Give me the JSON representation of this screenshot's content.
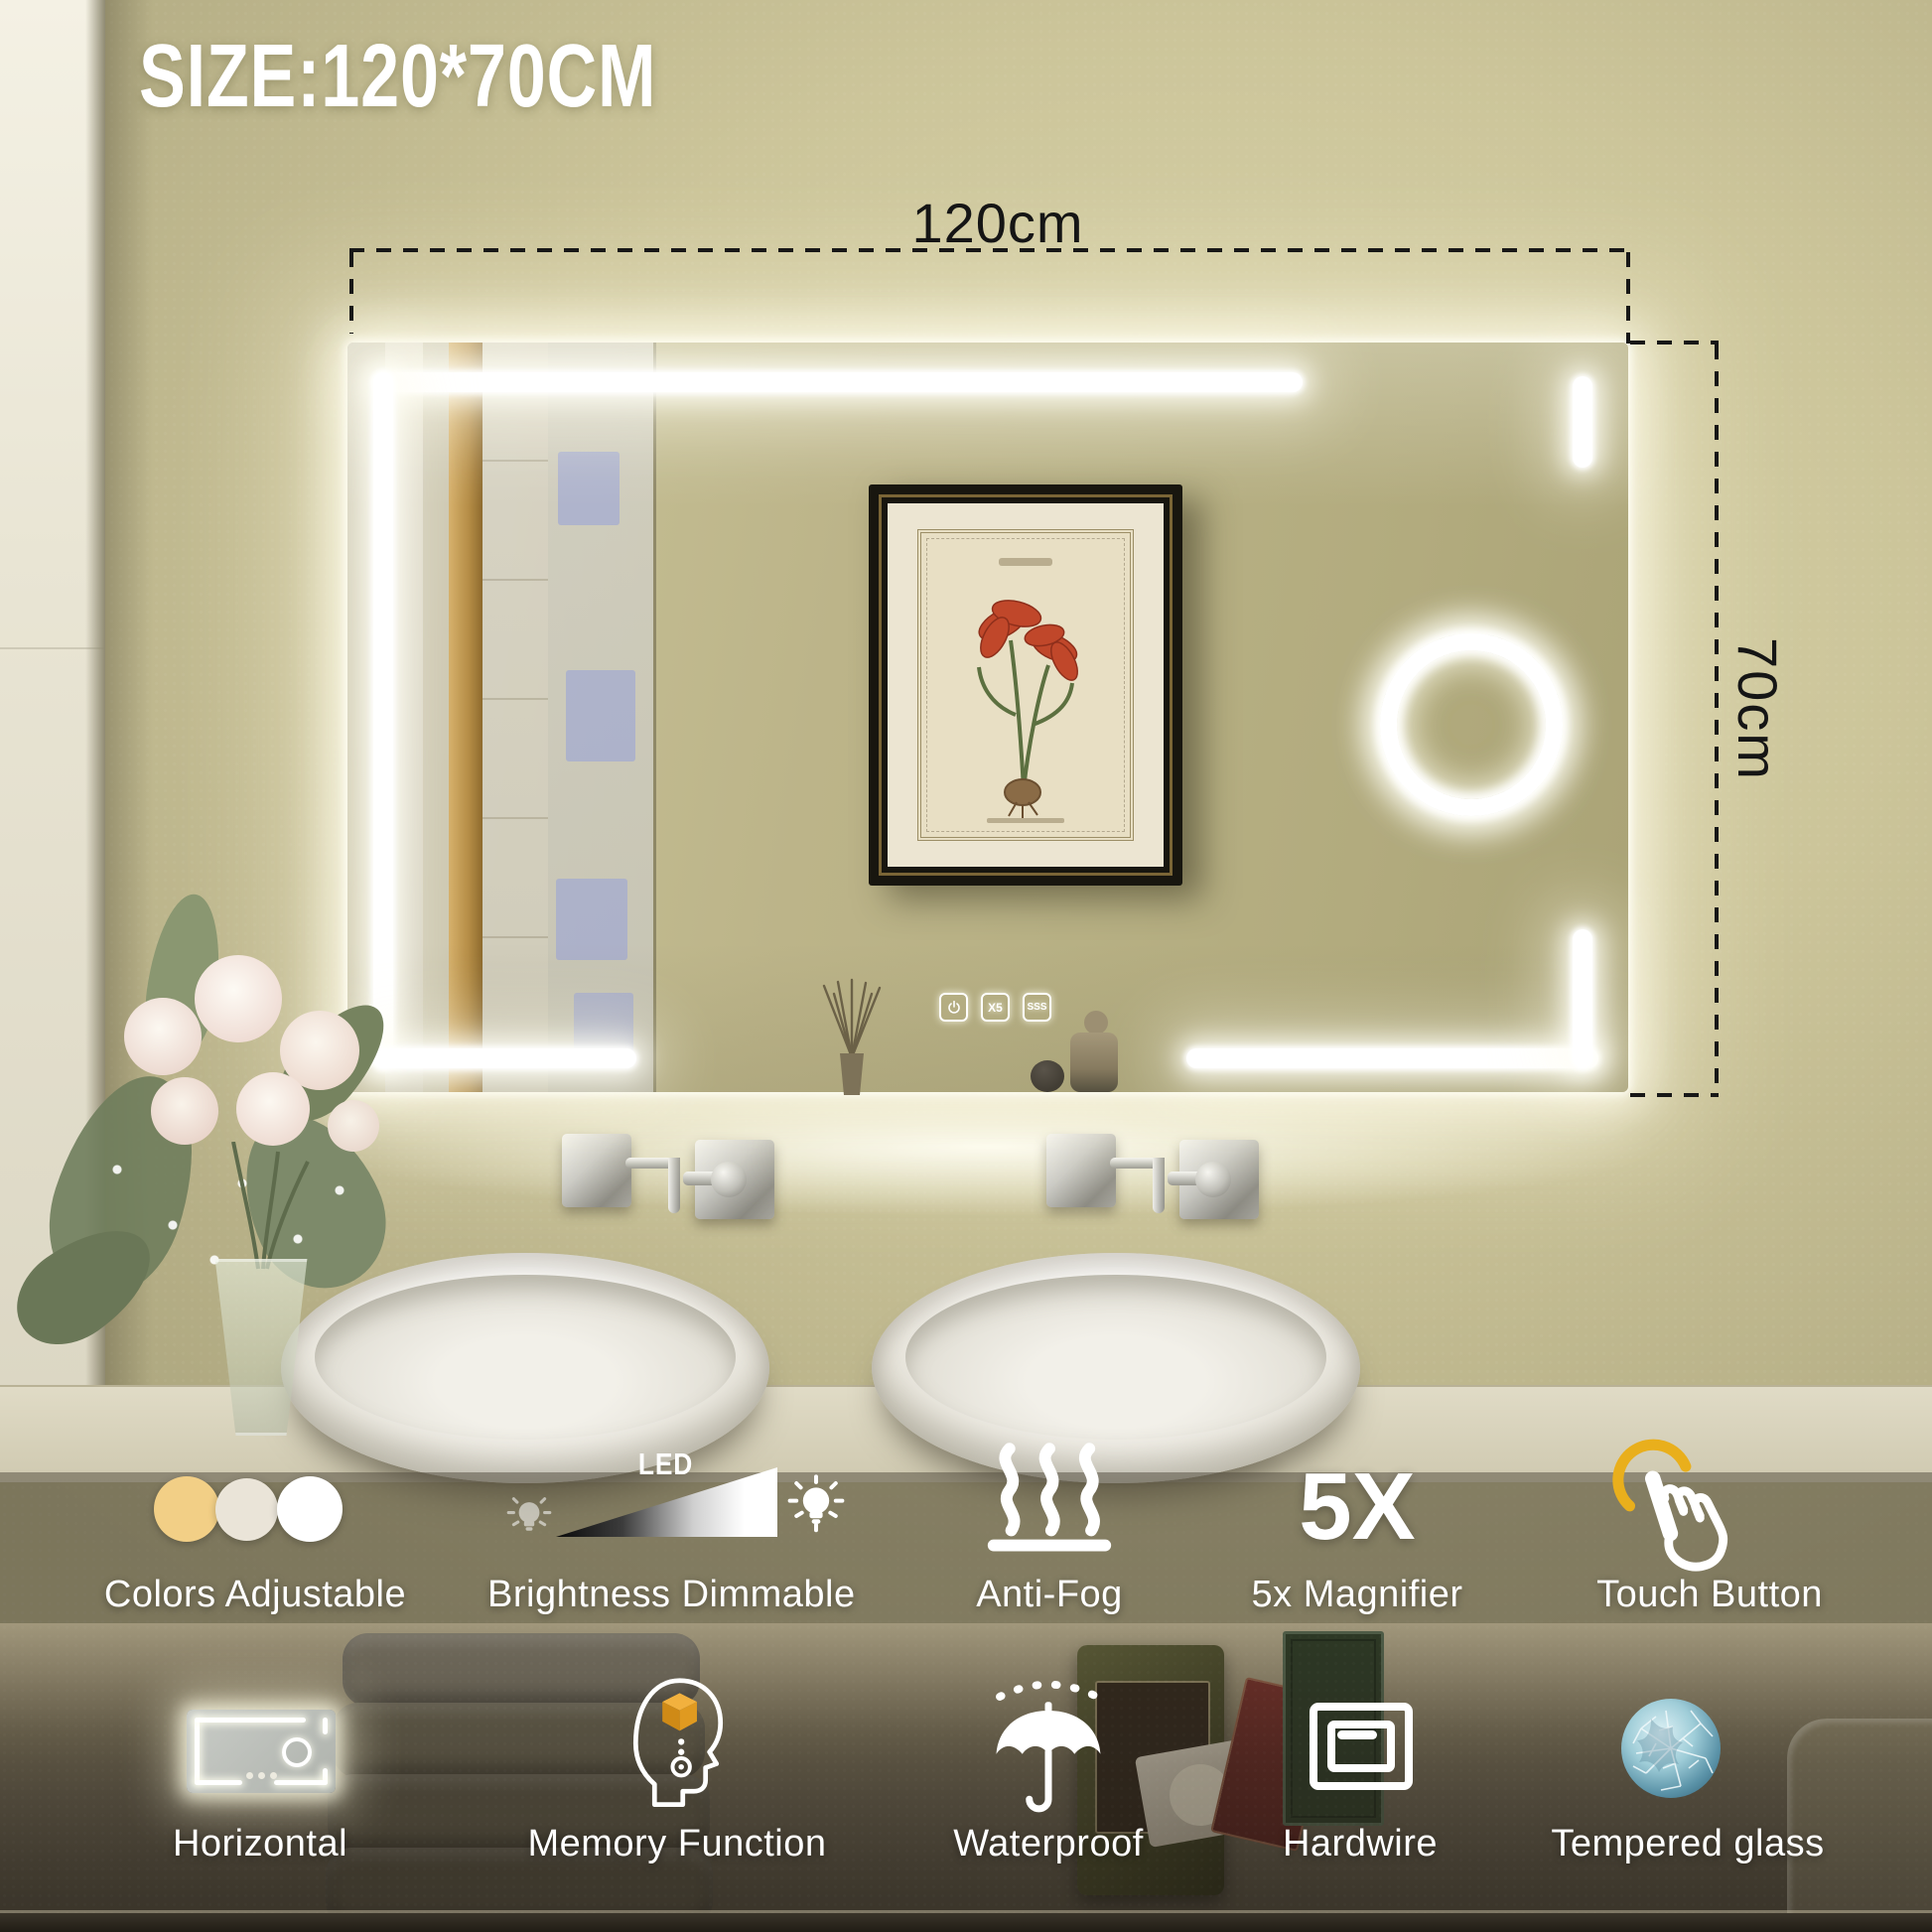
{
  "title": "SIZE:120*70CM",
  "dimensions": {
    "width": "120cm",
    "height": "70cm"
  },
  "mirror": {
    "buttons": {
      "power_icon": "power",
      "magnifier": "X5",
      "antifog": "SSS"
    }
  },
  "features_row1": [
    {
      "icon": "color-temperature-circles-icon",
      "label": "Colors Adjustable",
      "circle_colors": [
        "#f2cf86",
        "#eae4d8",
        "#ffffff"
      ]
    },
    {
      "icon": "led-dimmer-icon",
      "led_text": "LED",
      "label": "Brightness Dimmable"
    },
    {
      "icon": "steam-icon",
      "label": "Anti-Fog"
    },
    {
      "icon": "magnifier-5x-icon",
      "big_text": "5X",
      "label": "5x Magnifier"
    },
    {
      "icon": "touch-hand-icon",
      "label": "Touch Button",
      "accent": "#e9af1c"
    }
  ],
  "features_row2": [
    {
      "icon": "horizontal-mirror-icon",
      "label": "Horizontal"
    },
    {
      "icon": "memory-head-icon",
      "label": "Memory Function",
      "accent": "#eda92b"
    },
    {
      "icon": "umbrella-icon",
      "label": "Waterproof"
    },
    {
      "icon": "hardwire-box-icon",
      "label": "Hardwire"
    },
    {
      "icon": "tempered-glass-icon",
      "label": "Tempered glass"
    }
  ],
  "scene": {
    "led_color": "#ffffff",
    "wall_color": "#c6bf92",
    "dimension_line_color": "#171717"
  }
}
